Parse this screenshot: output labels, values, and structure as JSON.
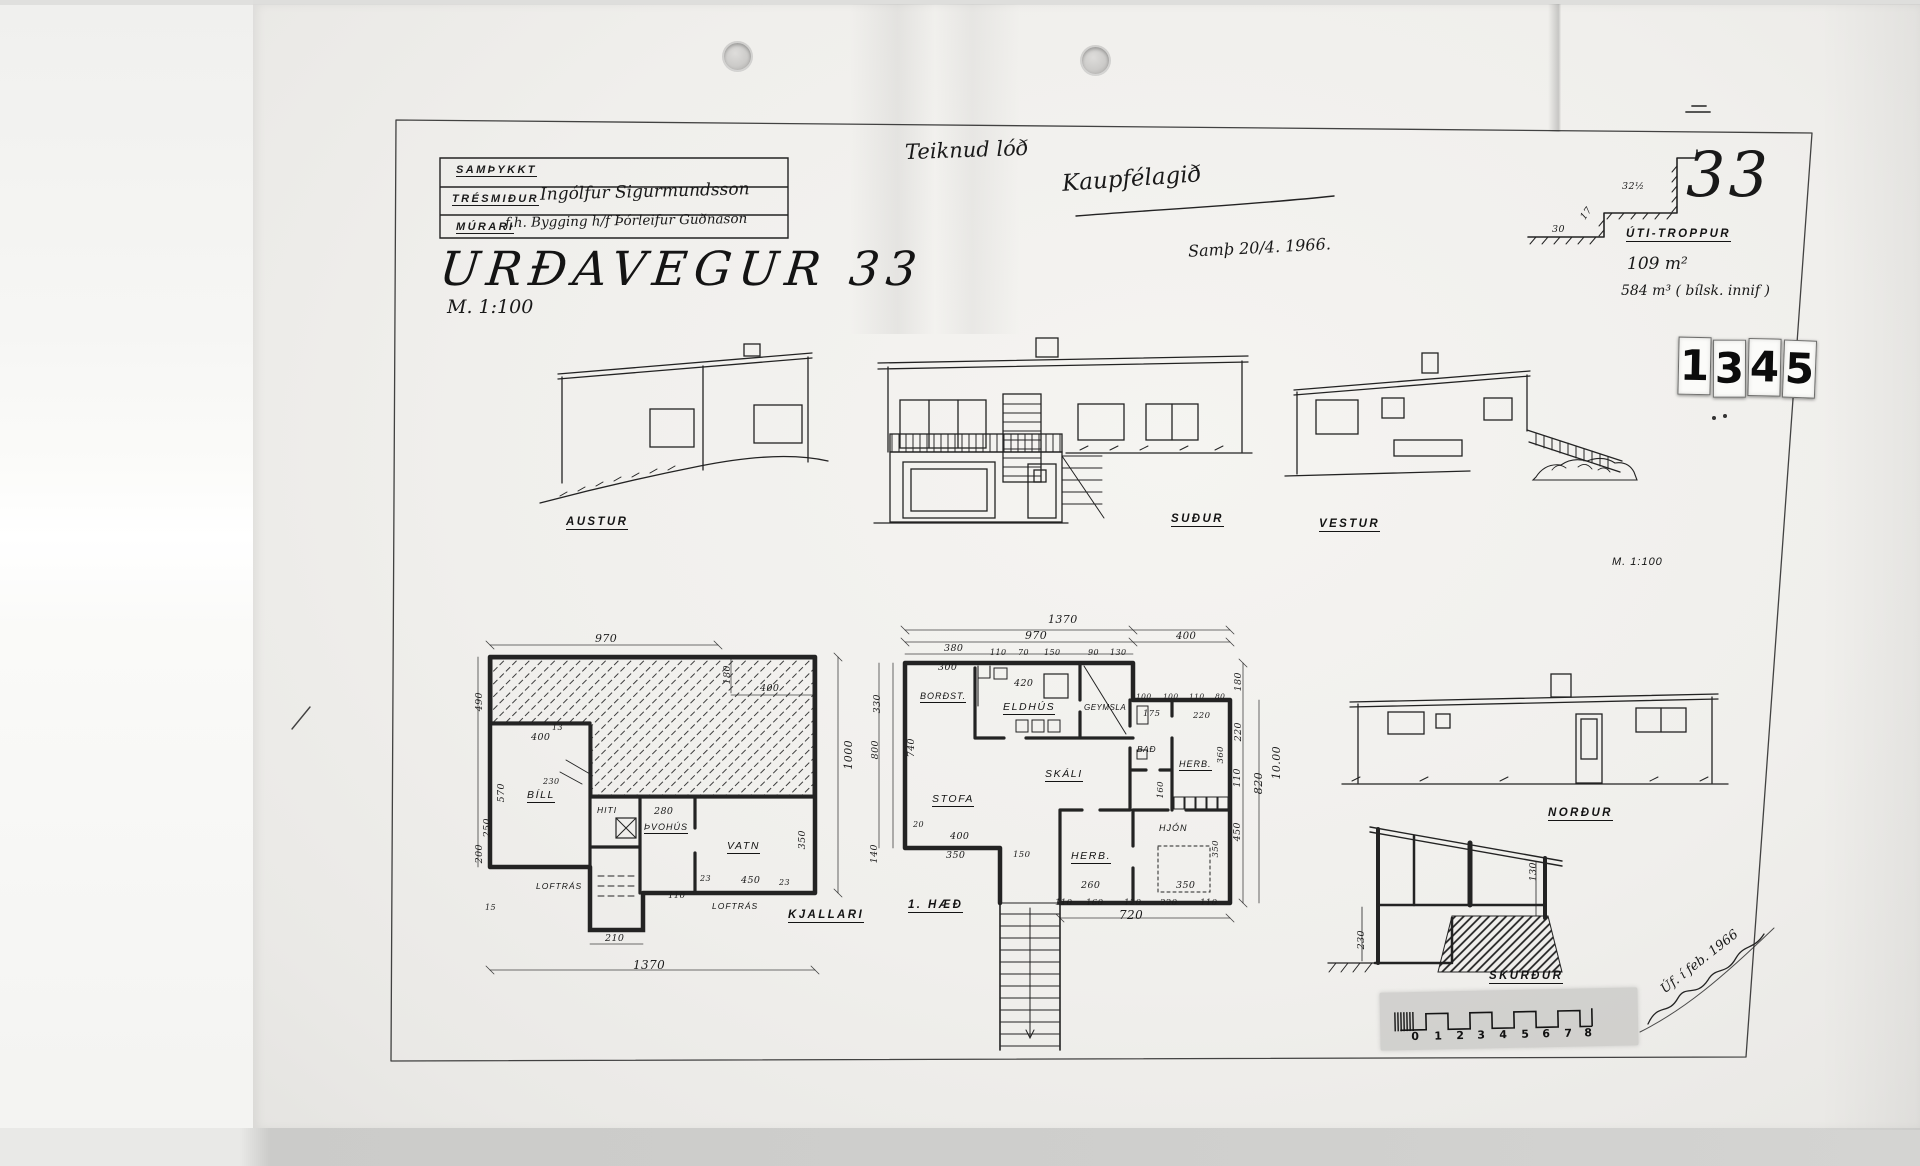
{
  "document": {
    "approval_box": {
      "approved": "SAMÞYKKT",
      "carpenter_label": "TRÉSMIÐUR",
      "carpenter_signature": "Ingólfur Sigurmundsson",
      "mason_label": "MÚRARI",
      "mason_signature": "f.h. Bygging h/f Þórleifur Guðnason"
    },
    "title": "URÐAVEGUR 33",
    "scale": "M. 1:100",
    "handwritten_note_1": "Teiknud lóð",
    "handwritten_note_2": "Kaupfélagið",
    "approval_date": "Samþ 20/4. 1966.",
    "plot_number": "33",
    "area": "109 m²",
    "volume": "584 m³ ( bílsk. innif )",
    "signature_note": "Úf. í feb. 1966"
  },
  "stamp": {
    "digits": [
      "1",
      "3",
      "4",
      "5"
    ]
  },
  "stair_detail": {
    "label": "ÚTI-TROPPUR",
    "dims": [
      "32½",
      "30",
      "17"
    ]
  },
  "elevations": {
    "east": "AUSTUR",
    "south": "SUÐUR",
    "west": "VESTUR",
    "north": "NORÐUR",
    "scale_note": "M. 1:100"
  },
  "basement": {
    "caption": "KJALLARI",
    "rooms": {
      "garage": "BÍLL",
      "heating": "HITI",
      "laundry": "ÞVOHÚS",
      "water": "VATN"
    },
    "vent_label": "LOFTRÁS",
    "dims": [
      "970",
      "180",
      "400",
      "490",
      "400",
      "13",
      "570",
      "250",
      "200",
      "230",
      "280",
      "1000",
      "350",
      "450",
      "23",
      "23",
      "110",
      "210",
      "1370",
      "15"
    ]
  },
  "main_floor": {
    "caption": "1. HÆÐ",
    "rooms": {
      "dining": "BORÐST.",
      "kitchen": "ELDHÚS",
      "storage": "GEYMSLA",
      "bath": "BAÐ",
      "room1": "HERB.",
      "hall": "SKÁLI",
      "living": "STOFA",
      "room2": "HERB.",
      "master": "HJÓN",
      "closet_note": "HJÓN"
    },
    "top_dims": [
      "1370",
      "970",
      "400",
      "380",
      "300",
      "110",
      "70",
      "150",
      "90",
      "130",
      "420"
    ],
    "right_dims": [
      "180",
      "220",
      "110",
      "820",
      "10.00",
      "450"
    ],
    "left_dims": [
      "330",
      "800",
      "740",
      "140",
      "20"
    ],
    "bottom_dims": [
      "400",
      "350",
      "150",
      "260",
      "350",
      "110",
      "160",
      "120",
      "220",
      "110",
      "720"
    ],
    "inner_dims": [
      "175",
      "220",
      "100",
      "100",
      "110",
      "80",
      "360",
      "160",
      "350"
    ]
  },
  "section": {
    "label": "SKURÐUR",
    "dims": [
      "230",
      "130"
    ]
  },
  "scale_bar": {
    "numbers": [
      "0",
      "1",
      "2",
      "3",
      "4",
      "5",
      "6",
      "7",
      "8"
    ]
  }
}
